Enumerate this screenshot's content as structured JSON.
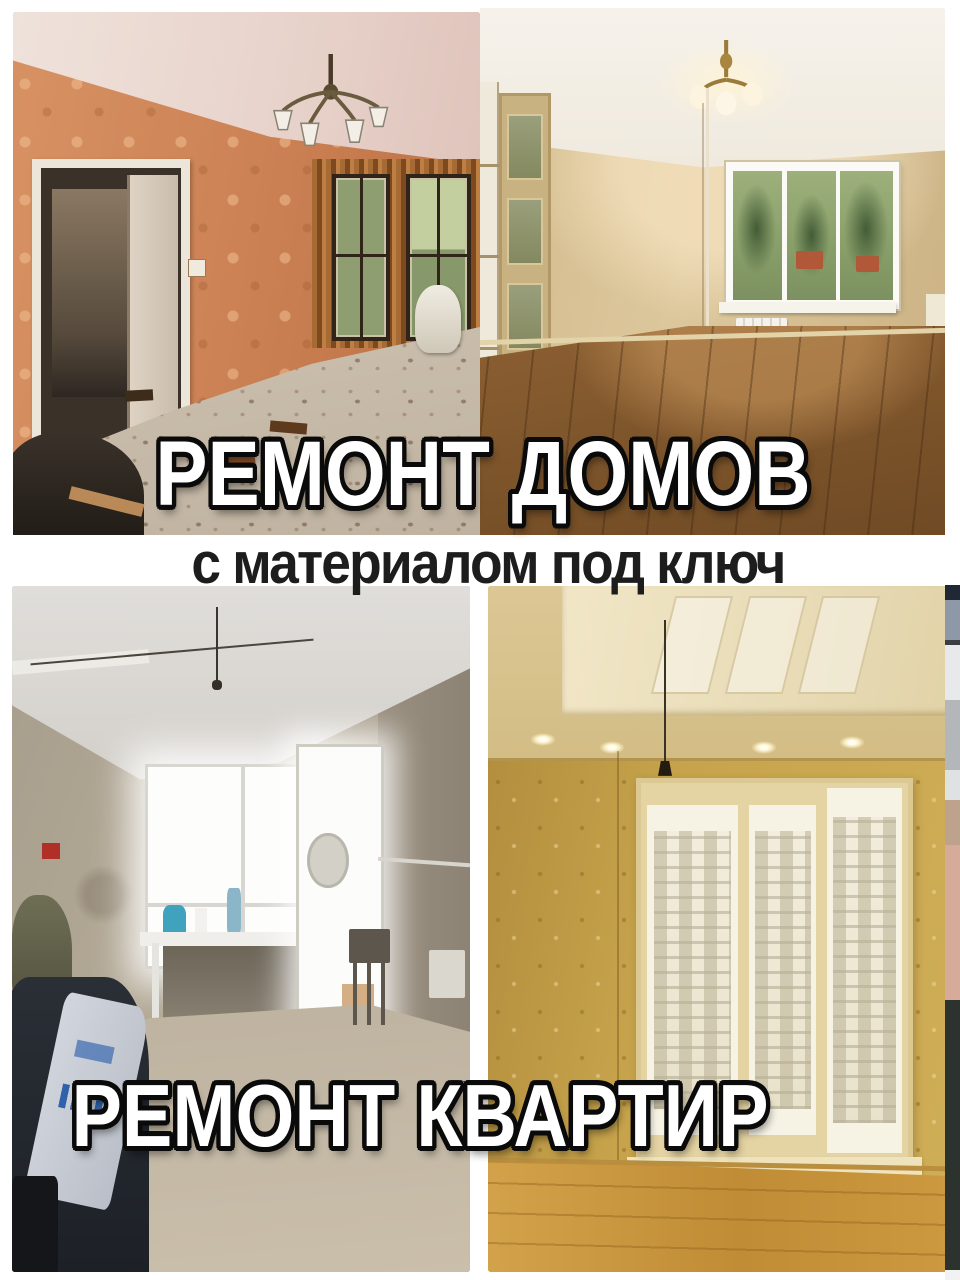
{
  "collage": {
    "top_title": "РЕМОНТ ДОМОВ",
    "middle_subtitle": "с материалом под ключ",
    "bottom_title": "РЕМОНТ КВАРТИР",
    "colors": {
      "background": "#ffffff",
      "title_fill": "#ffffff",
      "title_outline": "#0a0a0a",
      "subtitle_text": "#1d1d1d",
      "before_house_wall": "#cd8355",
      "after_house_wall": "#dcc79c",
      "before_apartment_wall": "#b3a996",
      "after_apartment_wall": "#c7a44c"
    },
    "photos": [
      {
        "id": "before-house",
        "label": "комната до ремонта: оранжевые обои, демонтаж, мусор на полу"
      },
      {
        "id": "after-house",
        "label": "комната после ремонта: бежевые стены, люстра, ламинат"
      },
      {
        "id": "before-apartment",
        "label": "комната до ремонта: черновые стены, окно с балконной дверью"
      },
      {
        "id": "after-apartment",
        "label": "комната после ремонта: золотистые обои, натяжной потолок, окно"
      }
    ]
  }
}
